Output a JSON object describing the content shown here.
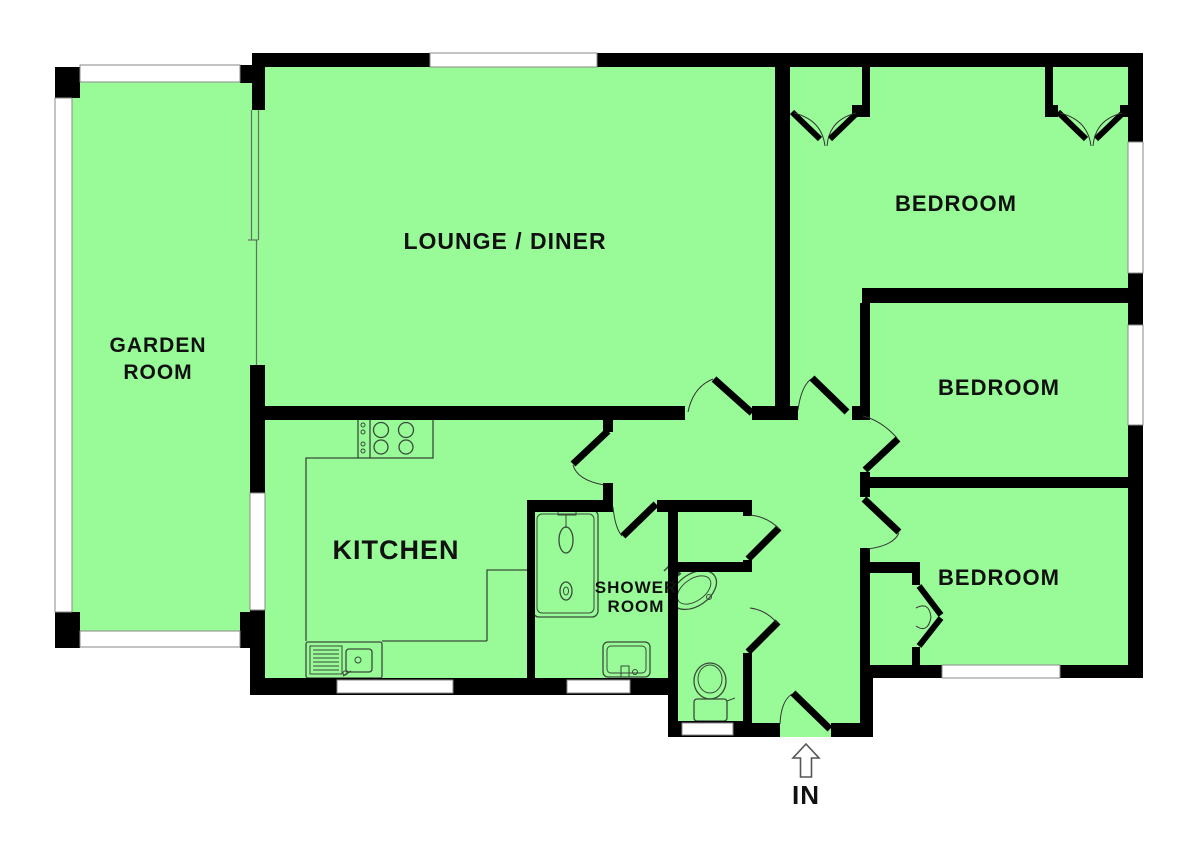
{
  "plan_title": "Bungalow floor plan",
  "colors": {
    "floor": "#98FB98",
    "wall": "#000000",
    "window": "#FFFFFF",
    "frame": "#8a8a8a",
    "fixture": "#3a4a3a",
    "glazing": "#667066",
    "label": "#111111",
    "background": "#FFFFFF",
    "arrow-outline": "#555555"
  },
  "rooms": {
    "garden_room": {
      "label_line1": "GARDEN",
      "label_line2": "ROOM"
    },
    "lounge_diner": {
      "label": "LOUNGE / DINER"
    },
    "bedroom_top": {
      "label": "BEDROOM"
    },
    "bedroom_middle": {
      "label": "BEDROOM"
    },
    "bedroom_bottom": {
      "label": "BEDROOM"
    },
    "kitchen": {
      "label": "KITCHEN"
    },
    "shower_room": {
      "label_line1": "SHOWER",
      "label_line2": "ROOM"
    }
  },
  "entrance": {
    "label": "IN"
  },
  "fixtures": [
    "hob-icon",
    "kitchen-sink-icon",
    "counter-outline",
    "shower-cubicle-icon",
    "vanity-unit-icon",
    "wc-basin-icon",
    "toilet-icon",
    "entrance-arrow-icon",
    "wardrobe-doors-icon",
    "cupboard-bifold-icon"
  ]
}
